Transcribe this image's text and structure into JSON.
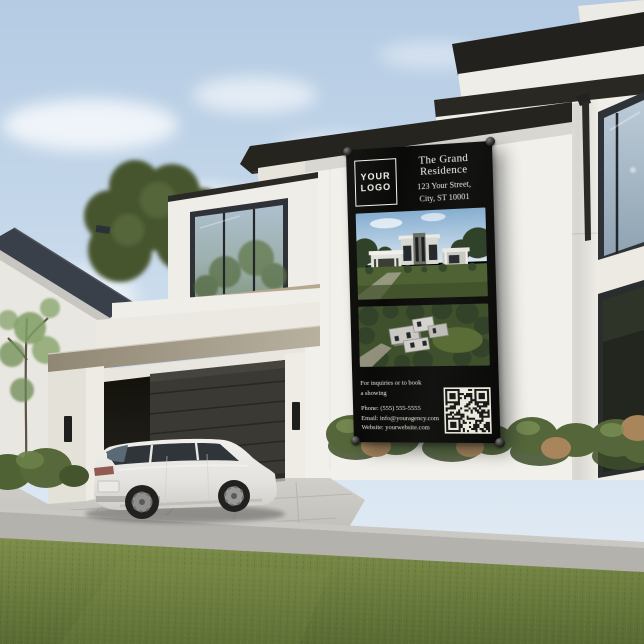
{
  "banner": {
    "logo_line1": "YOUR",
    "logo_line2": "LOGO",
    "property_name": "The Grand Residence",
    "address_line1": "123 Your Street,",
    "address_line2": "City, ST 10001",
    "inquiry_line1": "For inquiries or to book",
    "inquiry_line2": "a showing",
    "phone": "Phone: (555) 555-5555",
    "email": "Email: info@youragency.com",
    "website": "Website: yourwebsite.com"
  },
  "colors": {
    "banner_background": "#0d0d0c",
    "banner_text": "#f2efe8",
    "sky_top": "#b7cde4",
    "sky_bottom": "#e4eef6",
    "house_wall": "#f1efe9",
    "roof_trim": "#26241f",
    "accent_beam": "#a89f8c",
    "lawn_green": "#68793b",
    "walkway_gray": "#b3b2ad",
    "car_body": "#e9e8e4"
  }
}
